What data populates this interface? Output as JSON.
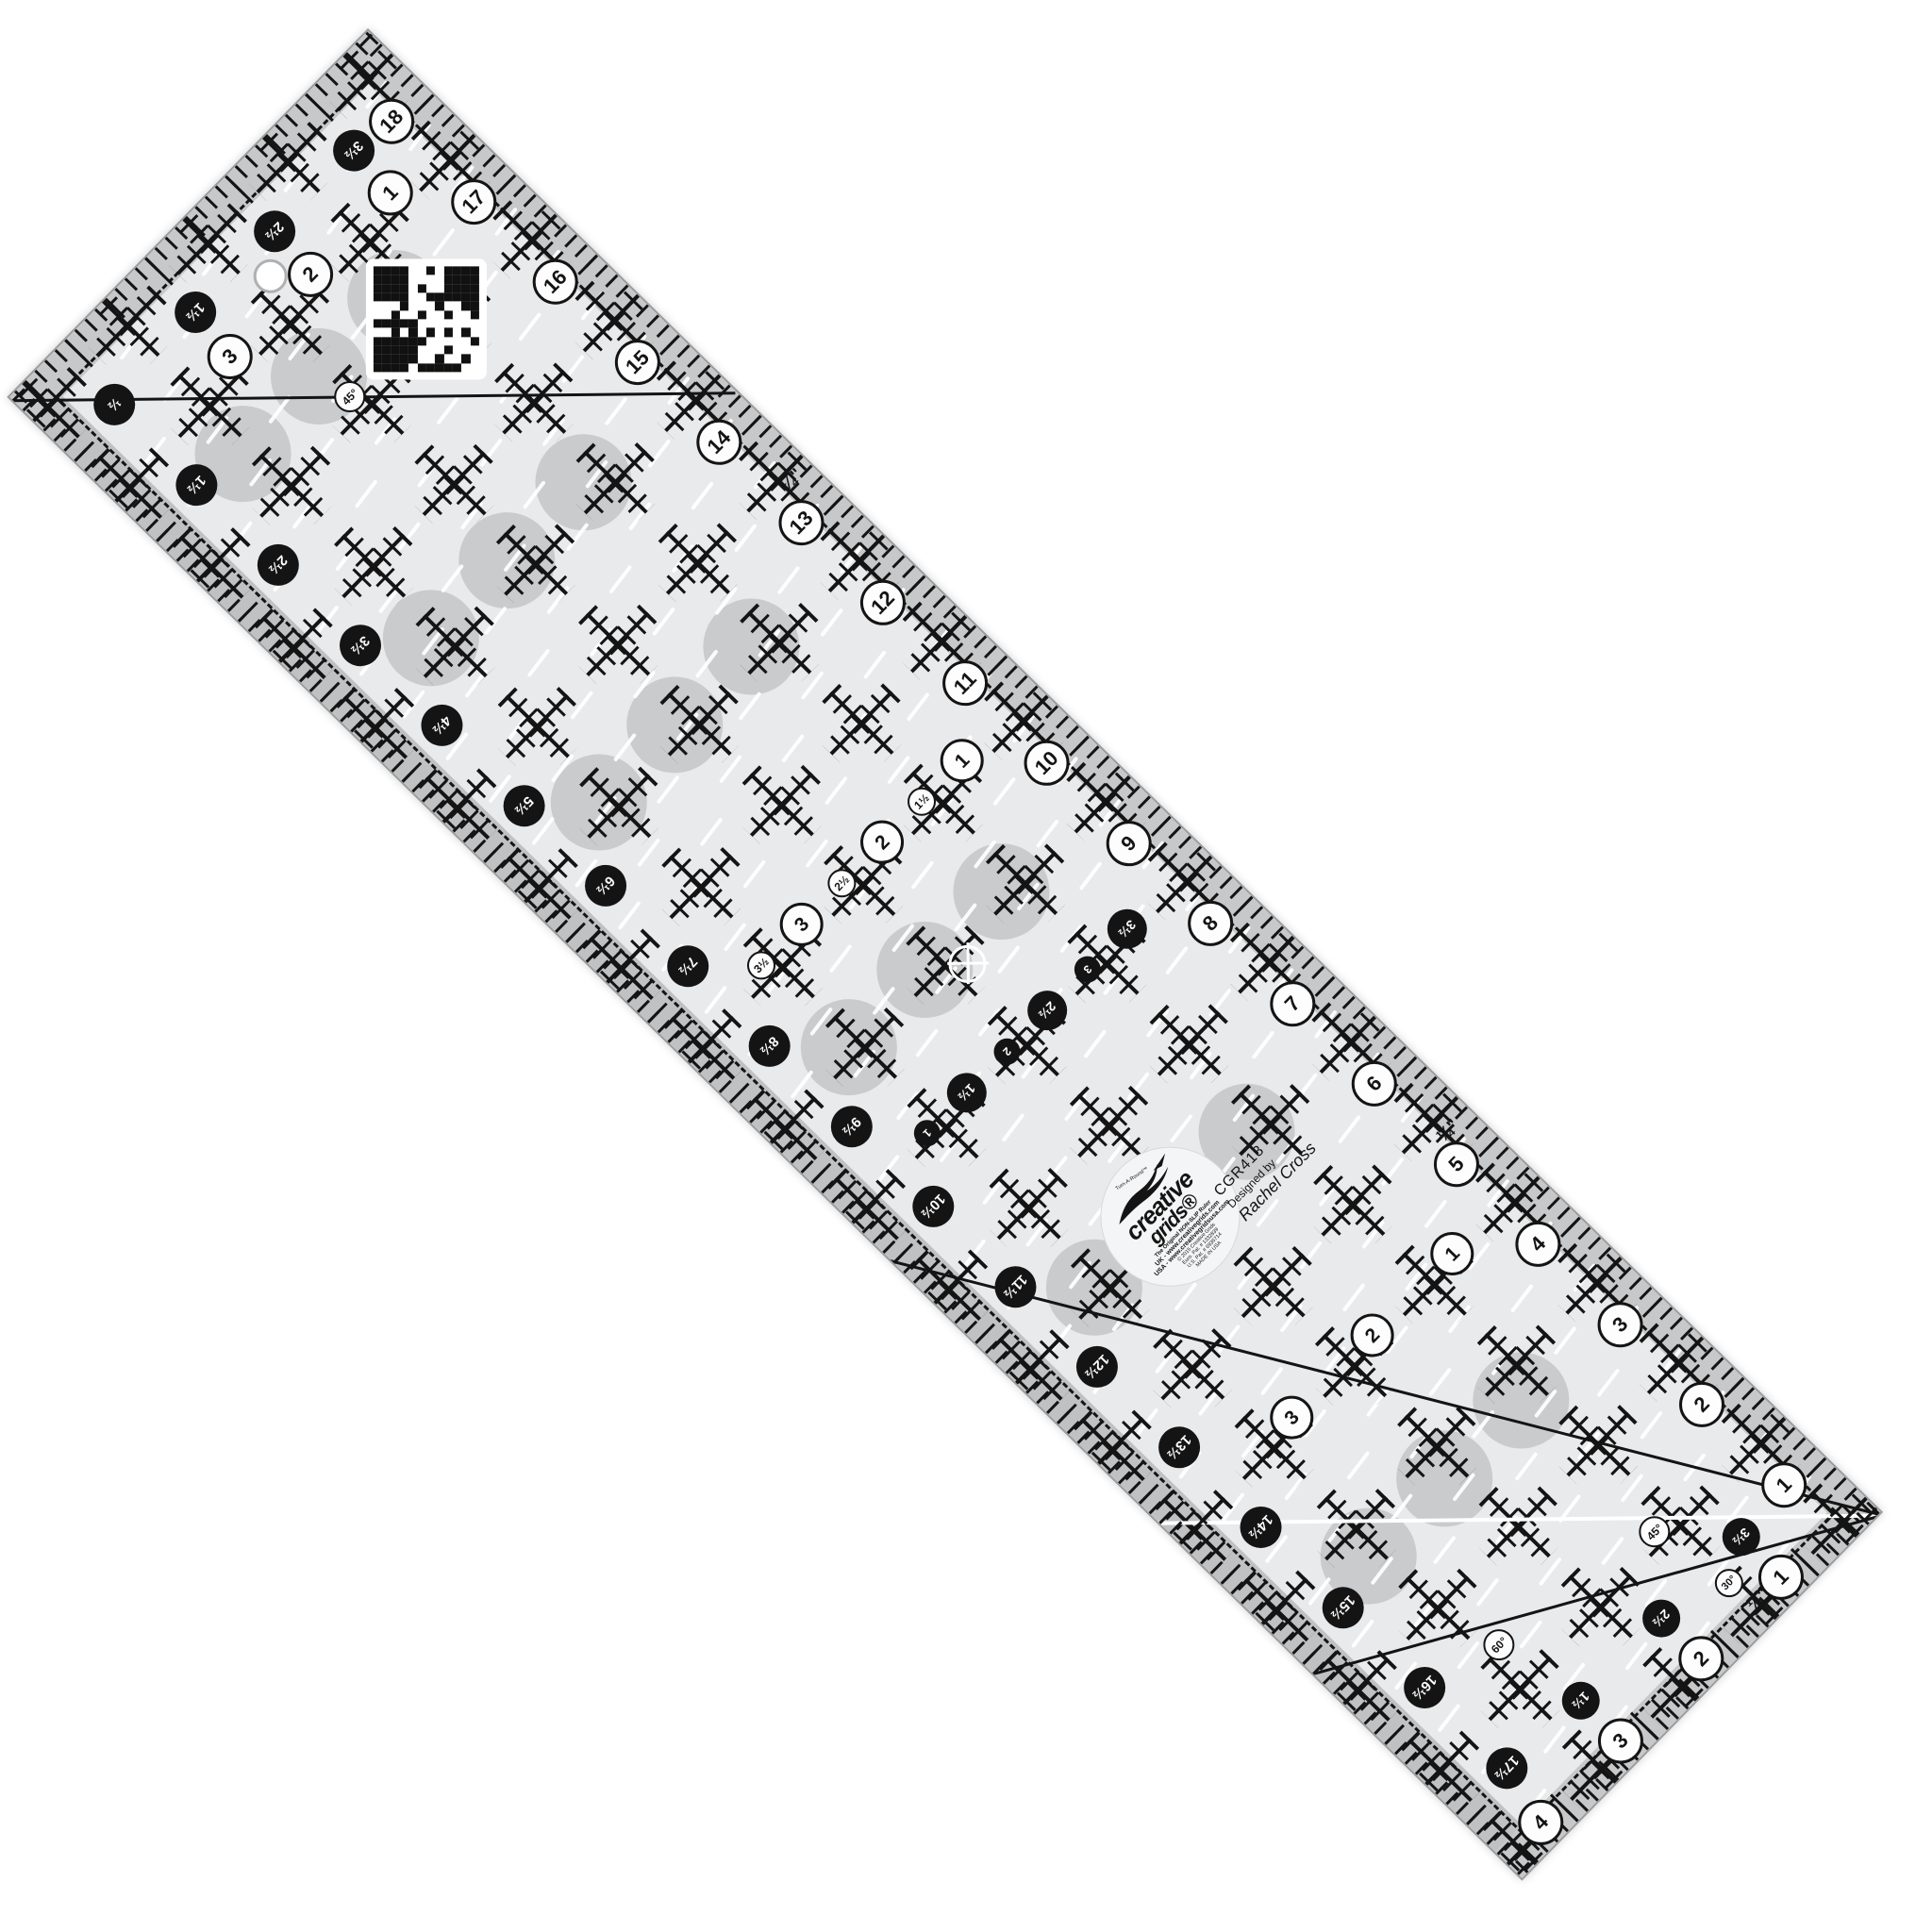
{
  "product": {
    "code": "CGR418",
    "designed_by_label": "Designed by",
    "designer": "Rachel Cross"
  },
  "logo": {
    "icon": "goose-icon",
    "tm_line": "Turn-A-Round™",
    "brand_top": "creative",
    "brand_bottom": "grids®",
    "tagline": "The Original NON-SLIP Ruler",
    "line_uk": "UK - www.creativegrids.com",
    "line_usa": "USA - www.creativegridsusa.com",
    "line_copyright": "© 2015 Creative Grids",
    "line_pat1": "Euro. Pat. # 1332839",
    "line_pat2": "U.S. Pat. # 6935714",
    "line_made": "MADE IN USA"
  },
  "scales": {
    "top_edge_white": [
      "18",
      "17",
      "16",
      "15",
      "14",
      "13",
      "12",
      "11",
      "10",
      "9",
      "8",
      "7",
      "6",
      "5",
      "4",
      "3",
      "2",
      "1"
    ],
    "bottom_edge_black": [
      "½",
      "1½",
      "2½",
      "3½",
      "4½",
      "5½",
      "6½",
      "7½",
      "8½",
      "9½",
      "10½",
      "11½",
      "12½",
      "13½",
      "14½",
      "15½",
      "16½",
      "17½"
    ],
    "left_edge_black": [
      "3½",
      "2½",
      "1½"
    ],
    "left_edge_white": [
      "1",
      "2",
      "3"
    ],
    "right_edge_white": [
      "1",
      "2",
      "3",
      "4"
    ],
    "right_inner_black": [
      "3½",
      "2½",
      "1½"
    ],
    "center_white_column": [
      "1",
      "1½",
      "2",
      "2½",
      "3",
      "3½"
    ],
    "center_black_column": [
      "3½",
      "3",
      "2½",
      "2",
      "1½",
      "1"
    ],
    "right_white_column": [
      "1",
      "2",
      "3"
    ]
  },
  "angle_labels": {
    "left_45": "45°",
    "right_45": "45°",
    "right_30": "30°",
    "right_60": "60°"
  },
  "quarter_inch_label": "¼\"",
  "icons": [
    "qr-code-icon",
    "goose-icon",
    "crosshair-icon",
    "hanging-hole"
  ],
  "colors": {
    "ruler_body": "#e9eaec",
    "edge_band": "#c6c8ca",
    "print_black": "#141414",
    "grip_dot_gray": "#c9cbcd",
    "circle_white": "#fdfdfd",
    "background": "#ffffff"
  }
}
